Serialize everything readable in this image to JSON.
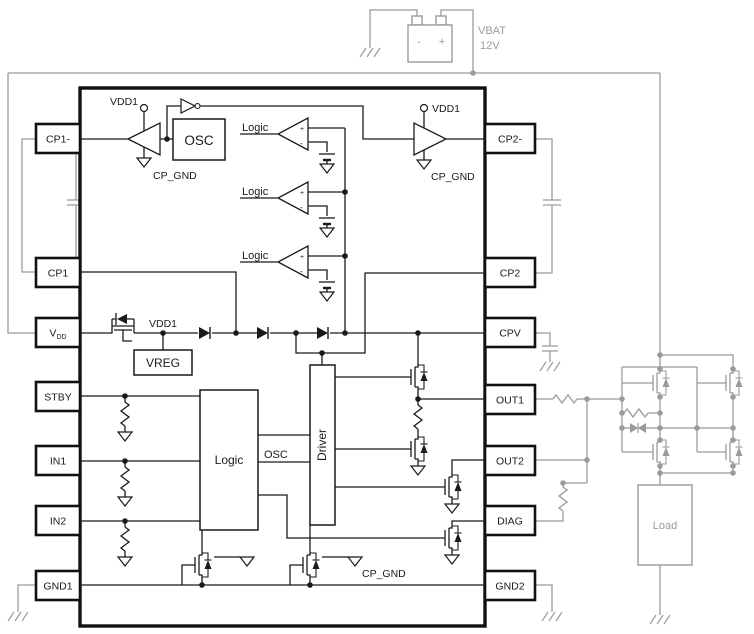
{
  "colors": {
    "ink": "#1a1a1a",
    "external_wire_gray": "#9b9b9b",
    "background": "#ffffff"
  },
  "battery": {
    "neg": "-",
    "pos": "+",
    "name": "VBAT",
    "voltage": "12V"
  },
  "load_label": "Load",
  "ic": {
    "pins_left": [
      {
        "label": "CP1-"
      },
      {
        "label": "CP1"
      },
      {
        "label": "V",
        "sub": "DD"
      },
      {
        "label": "STBY"
      },
      {
        "label": "IN1"
      },
      {
        "label": "IN2"
      },
      {
        "label": "GND1"
      }
    ],
    "pins_right": [
      {
        "label": "CP2-"
      },
      {
        "label": "CP2"
      },
      {
        "label": "CPV"
      },
      {
        "label": "OUT1"
      },
      {
        "label": "OUT2"
      },
      {
        "label": "DIAG"
      },
      {
        "label": "GND2"
      }
    ],
    "labels": {
      "vdd1": "VDD1",
      "cp_gnd": "CP_GND",
      "osc_box": "OSC",
      "vreg": "VREG",
      "logic_block": "Logic",
      "driver": "Driver",
      "osc_signal": "OSC",
      "comparator": "Logic"
    }
  }
}
